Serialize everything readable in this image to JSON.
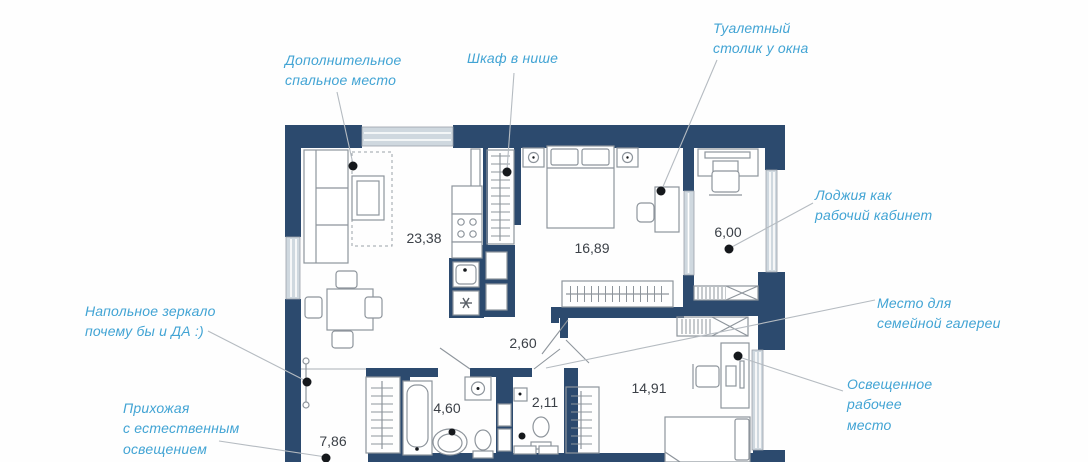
{
  "plan": {
    "colors": {
      "wall": "#2c4a6e",
      "annotation_text": "#42a4d4",
      "leader_line": "#b5bbc1",
      "furniture_outline": "#8e959c",
      "area_label": "#3b4047",
      "window_glazing": "#cfd8df"
    },
    "rooms": [
      {
        "id": "living-kitchen",
        "area": "23,38"
      },
      {
        "id": "bedroom",
        "area": "16,89"
      },
      {
        "id": "loggia",
        "area": "6,00"
      },
      {
        "id": "corridor",
        "area": "2,60"
      },
      {
        "id": "bathroom",
        "area": "4,60"
      },
      {
        "id": "wc",
        "area": "2,11"
      },
      {
        "id": "hallway",
        "area": "7,86"
      },
      {
        "id": "kids-room",
        "area": "14,91"
      }
    ]
  },
  "annotations": [
    {
      "id": "extra-sleeping-place",
      "text": "Дополнительное\nспальное место"
    },
    {
      "id": "niche-wardrobe",
      "text": "Шкаф в нише"
    },
    {
      "id": "dressing-table",
      "text": "Туалетный\nстолик у окна"
    },
    {
      "id": "loggia-office",
      "text": "Лоджия как\nрабочий кабинет"
    },
    {
      "id": "family-gallery",
      "text": "Место для\nсемейной галереи"
    },
    {
      "id": "lit-workplace",
      "text": "Освещенное\nрабочее\nместо"
    },
    {
      "id": "floor-mirror",
      "text": "Напольное зеркало\nпочему бы и ДА :)"
    },
    {
      "id": "hallway-light",
      "text": "Прихожая\nс естественным\nосвещением"
    }
  ]
}
